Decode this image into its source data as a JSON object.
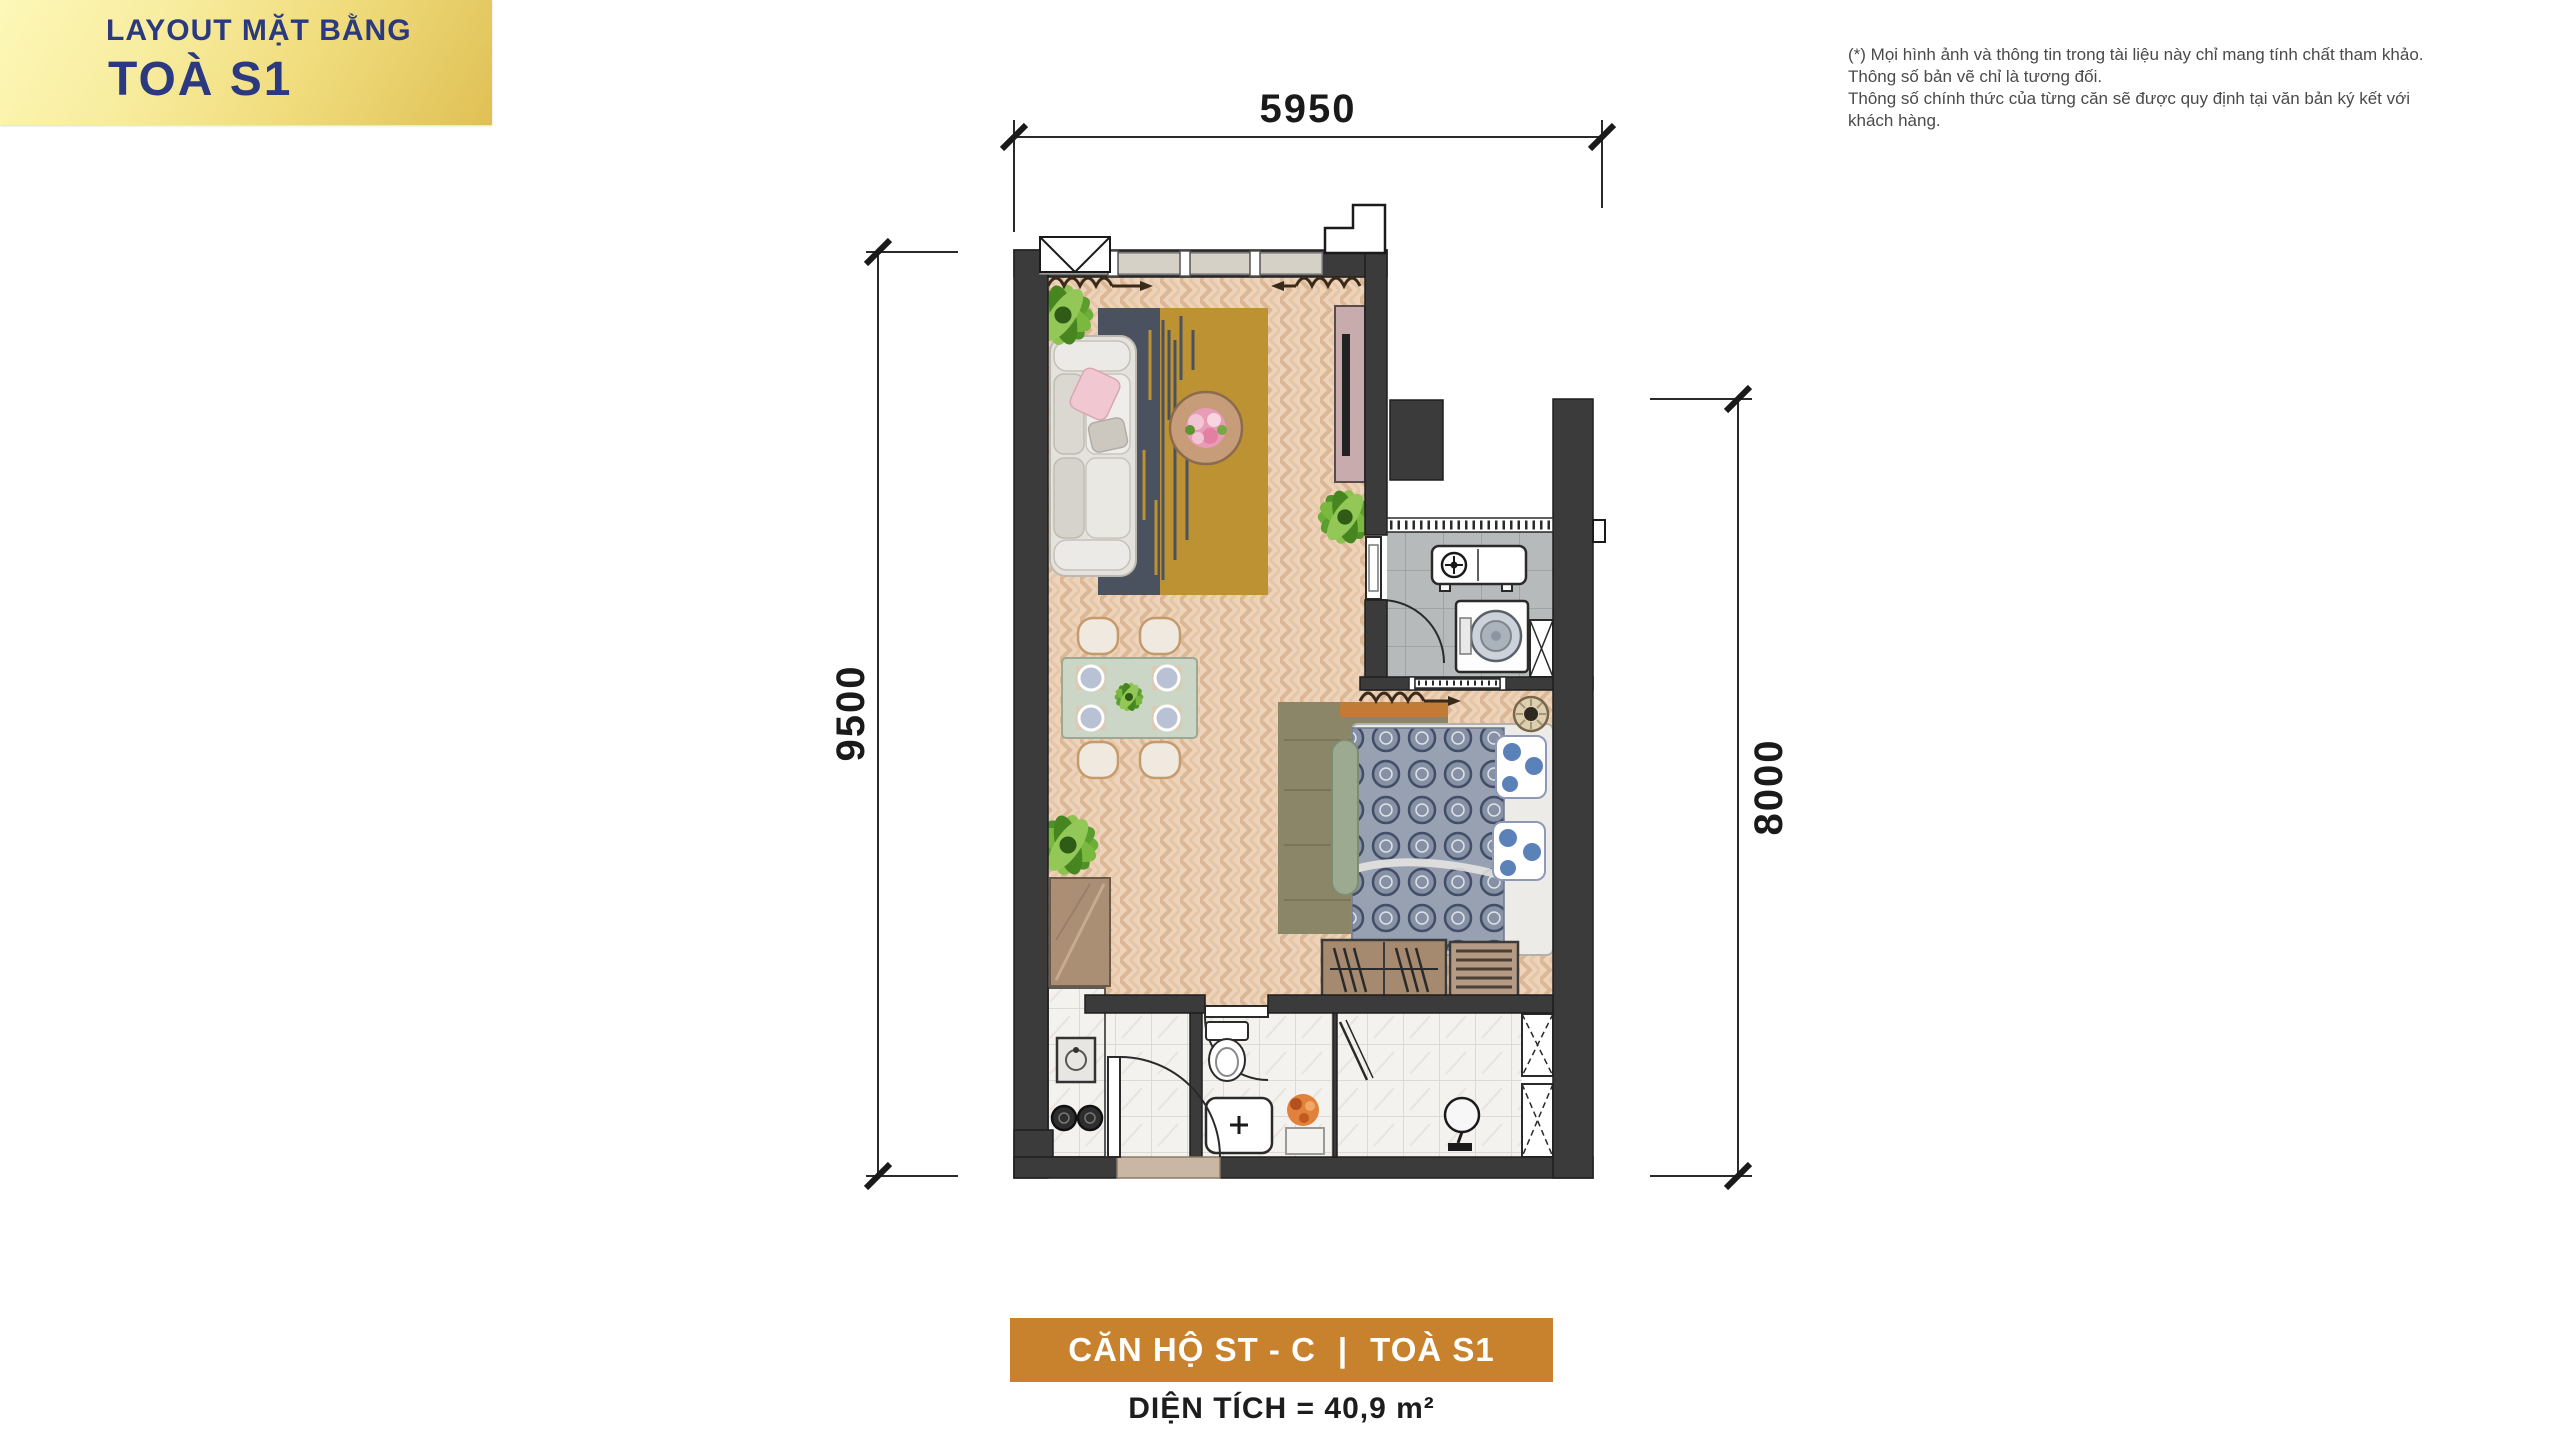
{
  "header": {
    "line1": "LAYOUT MẶT BẰNG",
    "line2": "TOÀ S1"
  },
  "disclaimer": {
    "line1": "(*) Mọi hình ảnh và thông tin trong tài liệu này chỉ mang tính chất tham khảo. Thông số bản vẽ chỉ là tương đối.",
    "line2": "Thông số chính thức của từng căn sẽ được quy định tại văn bản ký kết với khách hàng."
  },
  "plan": {
    "dim_top": "5950",
    "dim_left": "9500",
    "dim_right": "8000",
    "rooms": [
      "living-dining",
      "kitchen-laundry",
      "bedroom",
      "bathroom",
      "foyer"
    ]
  },
  "footer": {
    "unit": "CĂN HỘ ST - C",
    "sep": "|",
    "tower": "TOÀ S1",
    "area": "DIỆN TÍCH = 40,9 m²"
  },
  "colors": {
    "header_navy": "#2b3a80",
    "header_gold_light": "#fdf8b8",
    "header_gold_dark": "#dfc055",
    "footer_orange": "#c8822e",
    "wall": "#3b3b3b",
    "wood_floor": "#ecd3ba",
    "kitchen_tile": "#b7babb",
    "marble": "#f4f2ef",
    "rug_blue": "#49525e",
    "rug_gold": "#bd9232",
    "bed_pattern": "#98a1b2",
    "plant_green": "#6cae3a"
  }
}
